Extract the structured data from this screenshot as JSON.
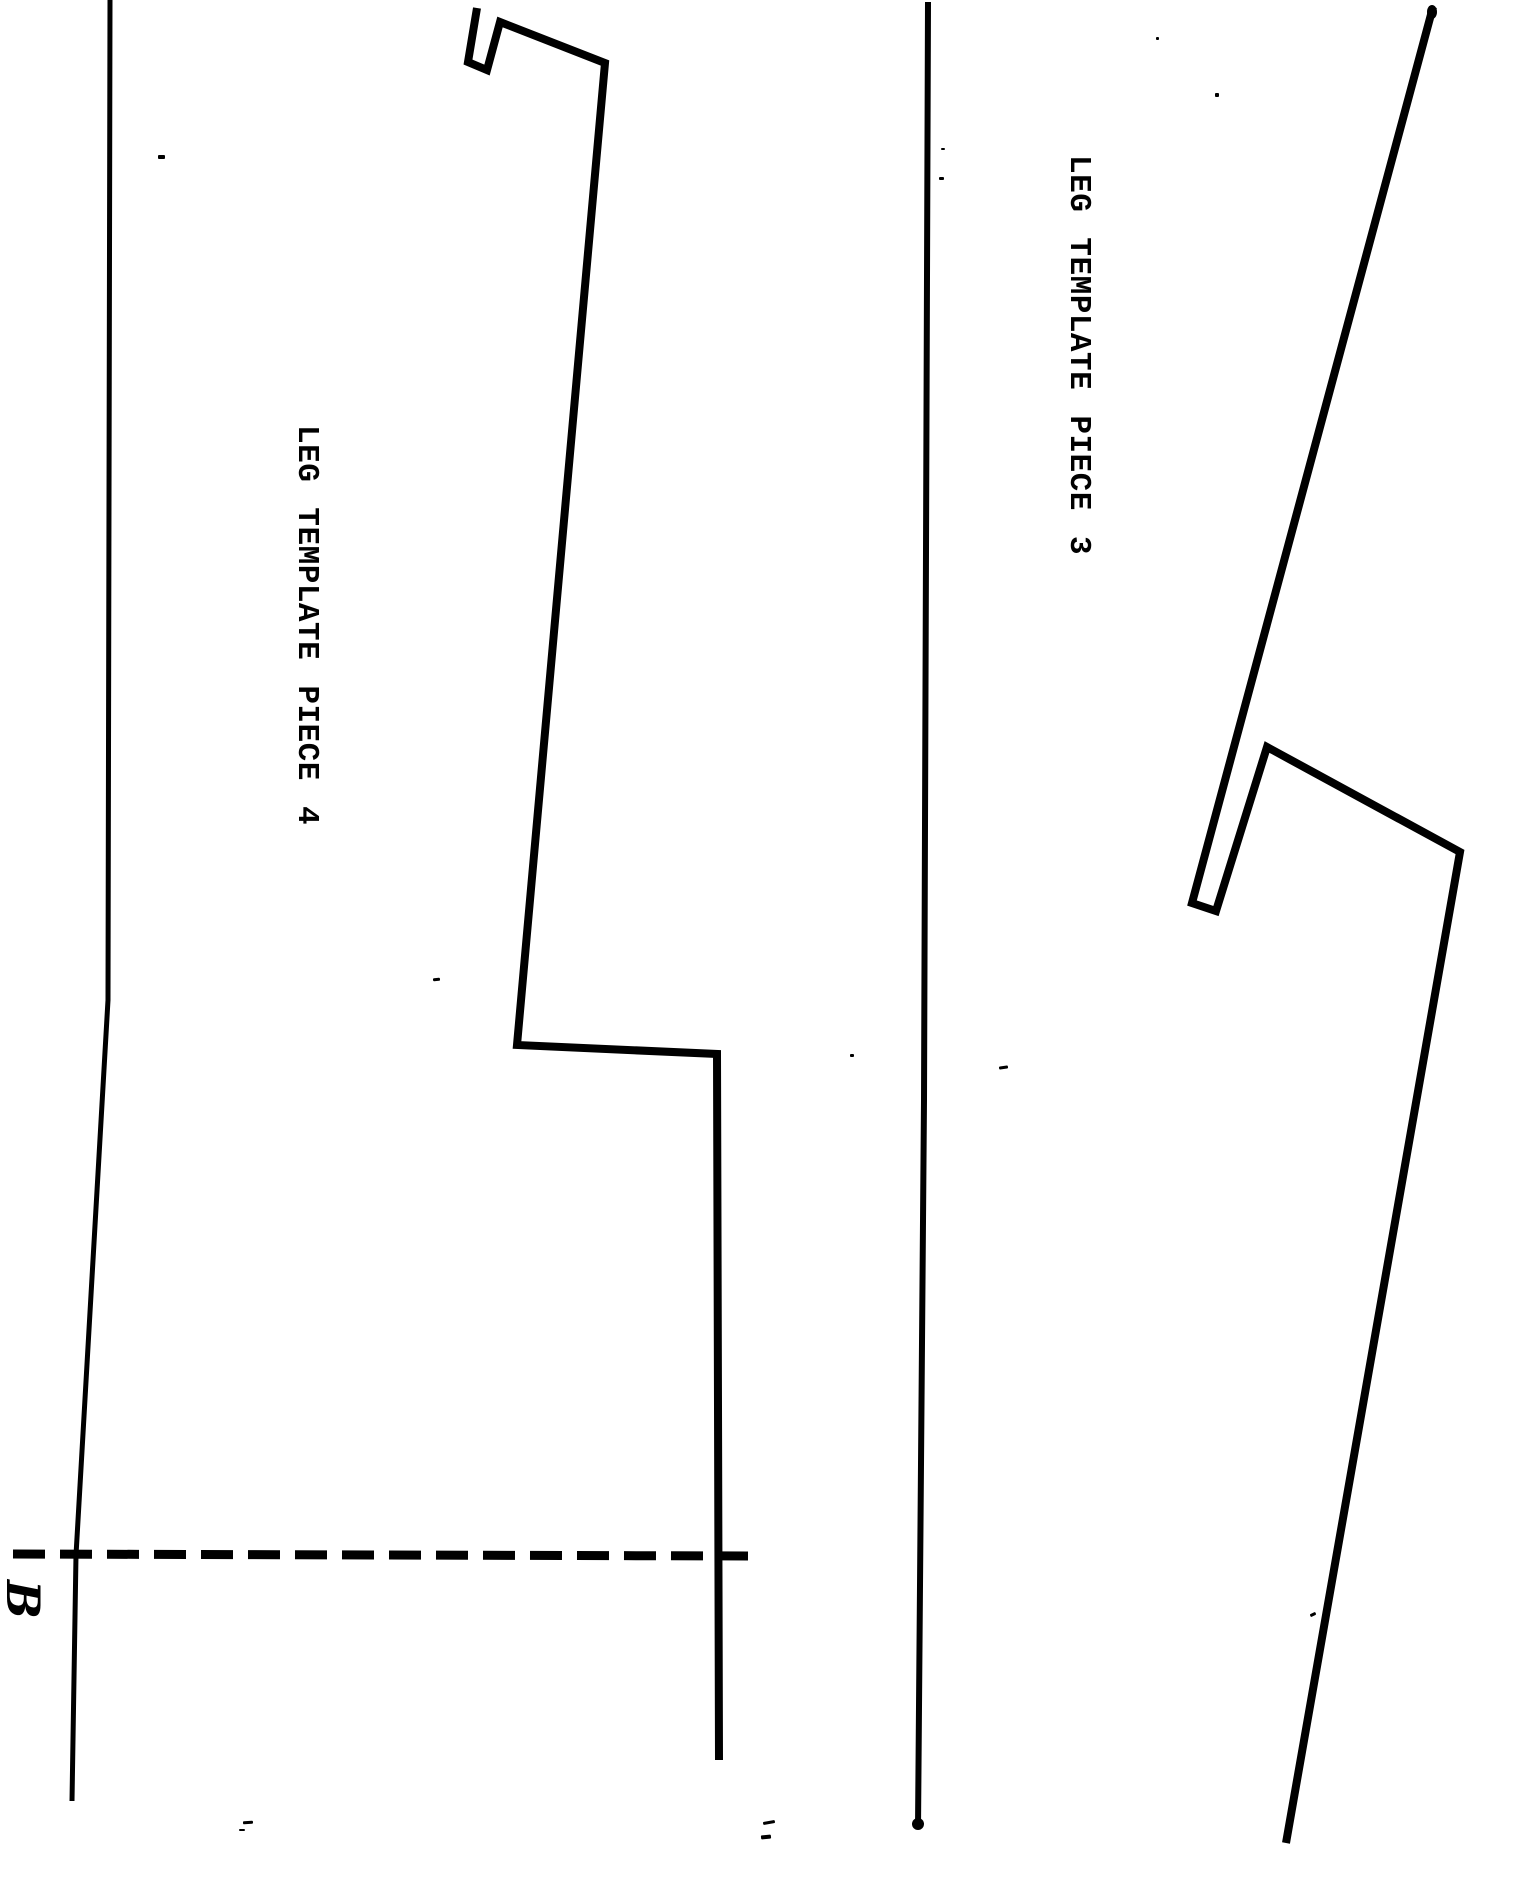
{
  "colors": {
    "paper": "#ffffff",
    "ink": "#000000"
  },
  "labels": {
    "piece3": "LEG TEMPLATE PIECE 3",
    "piece4": "LEG TEMPLATE PIECE 4",
    "handwritten_mark": "B"
  },
  "shapes": [
    {
      "name": "left-page-rule",
      "type": "polyline",
      "points": "110,0 108,1000 76,1555 72,1801",
      "stroke_width": 5
    },
    {
      "name": "center-page-rule",
      "type": "polyline",
      "points": "928,2 924,1100 918,1828",
      "stroke_width": 6
    },
    {
      "name": "piece4-outline",
      "type": "polyline",
      "points": "477,8 468,62 487,70 500,22 605,63 517,1045 717,1054 719,1760",
      "stroke_width": 8
    },
    {
      "name": "piece4-cut-dashed-line",
      "type": "line",
      "x1": 13,
      "y1": 1554,
      "x2": 748,
      "y2": 1556,
      "stroke_width": 9,
      "dash": "32 15"
    },
    {
      "name": "piece3-outline",
      "type": "polyline",
      "points": "1433,7 1192,903 1216,911 1267,747 1460,852 1286,1843",
      "stroke_width": 8
    },
    {
      "name": "center-rule-foot-blob",
      "type": "ellipse",
      "cx": 918,
      "cy": 1824,
      "rx": 6,
      "ry": 6
    },
    {
      "name": "piece3-tip-blob",
      "type": "ellipse",
      "cx": 1432,
      "cy": 12,
      "rx": 5,
      "ry": 7
    }
  ],
  "scan_artifacts": [
    {
      "x": 158,
      "y": 155,
      "w": 7,
      "h": 4,
      "rot": 0
    },
    {
      "x": 941,
      "y": 148,
      "w": 4,
      "h": 2,
      "rot": 0
    },
    {
      "x": 939,
      "y": 177,
      "w": 5,
      "h": 3,
      "rot": 0
    },
    {
      "x": 1156,
      "y": 37,
      "w": 3,
      "h": 3,
      "rot": 0
    },
    {
      "x": 1215,
      "y": 93,
      "w": 4,
      "h": 4,
      "rot": 0
    },
    {
      "x": 433,
      "y": 978,
      "w": 7,
      "h": 3,
      "rot": -5
    },
    {
      "x": 999,
      "y": 1066,
      "w": 9,
      "h": 3,
      "rot": -8
    },
    {
      "x": 850,
      "y": 1054,
      "w": 4,
      "h": 3,
      "rot": 0
    },
    {
      "x": 243,
      "y": 1821,
      "w": 10,
      "h": 3,
      "rot": -4
    },
    {
      "x": 239,
      "y": 1829,
      "w": 6,
      "h": 2,
      "rot": 0
    },
    {
      "x": 763,
      "y": 1821,
      "w": 12,
      "h": 3,
      "rot": -10
    },
    {
      "x": 761,
      "y": 1835,
      "w": 10,
      "h": 4,
      "rot": -6
    },
    {
      "x": 1310,
      "y": 1613,
      "w": 6,
      "h": 3,
      "rot": -25
    }
  ]
}
